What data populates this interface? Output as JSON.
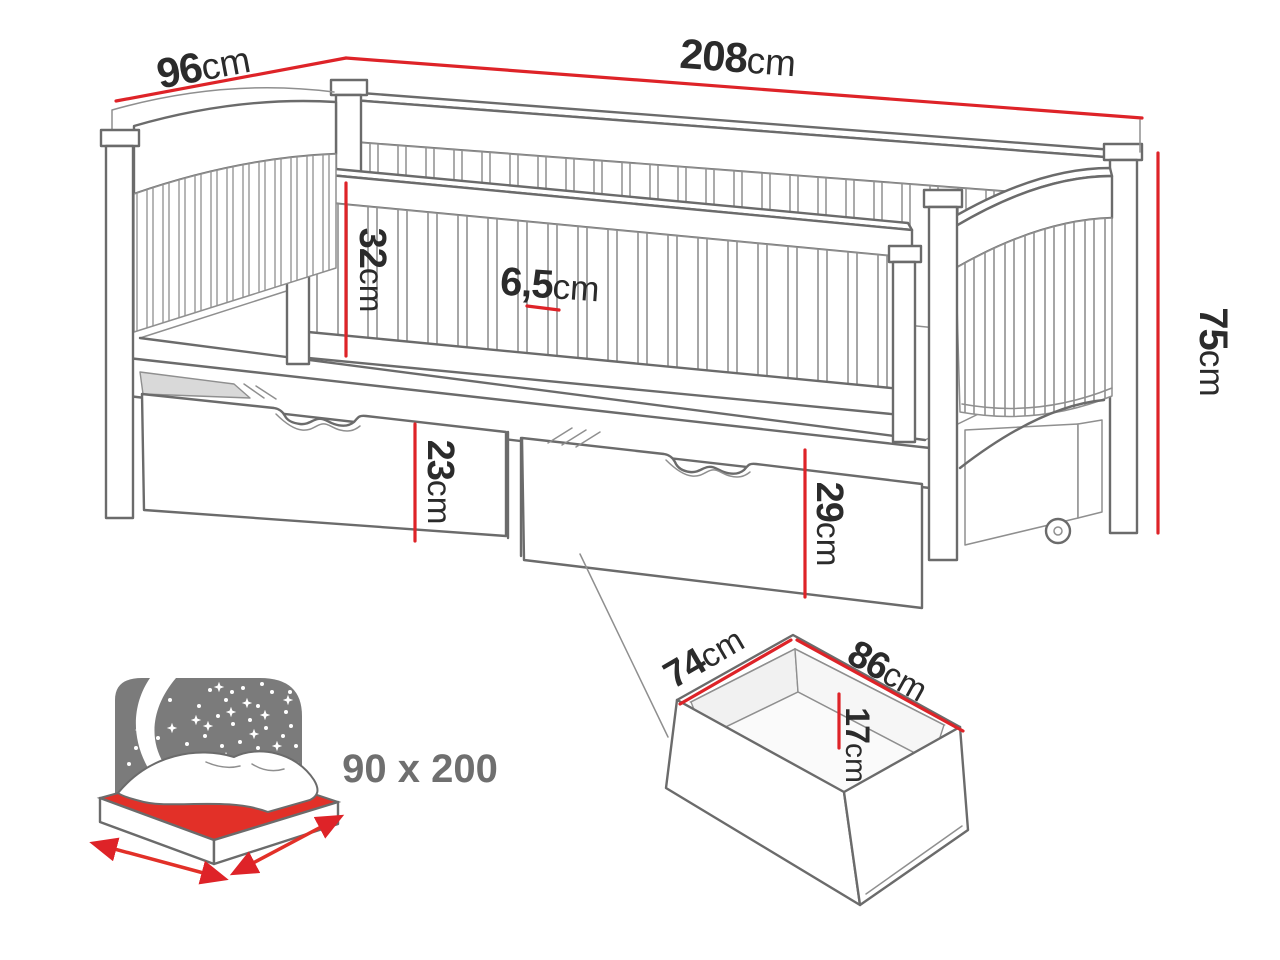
{
  "figure": {
    "type": "furniture-dimension-diagram",
    "subject": "single bed with guard rail and two storage drawers",
    "accent_color": "#de2328",
    "line_color": "#6b6b6b",
    "label_color": "#2b2b2b",
    "dimensions": {
      "bed_depth": {
        "value": "96",
        "unit": "cm"
      },
      "bed_length": {
        "value": "208",
        "unit": "cm"
      },
      "bed_height": {
        "value": "75",
        "unit": "cm"
      },
      "guard_rail_height": {
        "value": "32",
        "unit": "cm"
      },
      "slat_gap": {
        "value": "6,5",
        "unit": "cm"
      },
      "left_drawer_front_height": {
        "value": "23",
        "unit": "cm"
      },
      "right_drawer_front_height": {
        "value": "29",
        "unit": "cm"
      },
      "drawer_depth": {
        "value": "74",
        "unit": "cm"
      },
      "drawer_width": {
        "value": "86",
        "unit": "cm"
      },
      "drawer_inner_height": {
        "value": "17",
        "unit": "cm"
      }
    },
    "mattress_badge": {
      "label": "90 x 200"
    }
  }
}
